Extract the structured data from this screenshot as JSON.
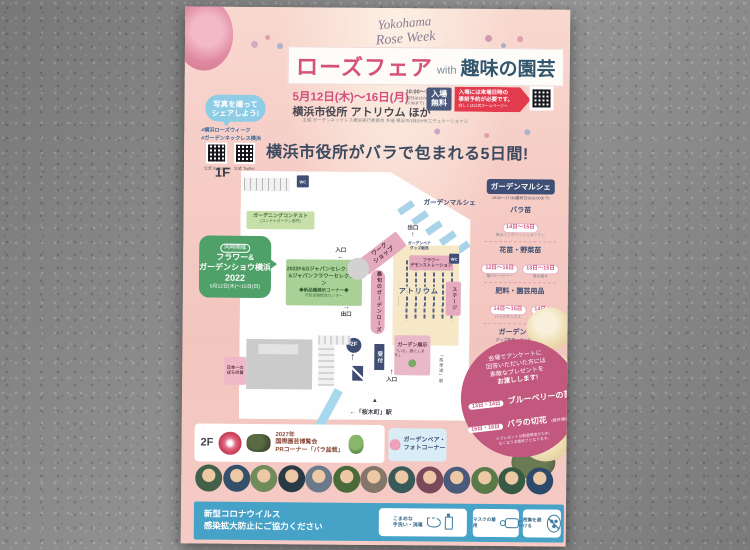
{
  "flyer": {
    "brand": {
      "line1": "Yokohama",
      "line2": "Rose Week"
    },
    "title": {
      "main": "ローズフェア",
      "with_word": "with",
      "sub": "趣味の園芸"
    },
    "info": {
      "date": "5月12日(木)〜16日(月)",
      "time1": "10:00〜18:00",
      "time2": "(初日は13:00〜、最終日は17:00まで)",
      "venue": "横浜市役所 アトリウム ほか",
      "admission1": "入場",
      "admission2": "無料",
      "reserve1": "入場には来場日時の",
      "reserve2": "事前予約が必要です。",
      "reserve3": "詳しくは公式ホームページへ",
      "credit": "主催 ガーデンネックレス横浜実行委員会 共催 横浜市/(株)NHKエデュケーショナル"
    },
    "share": {
      "bubble1": "写真を撮って",
      "bubble2": "シェアしよう!",
      "tag1": "#横浜ローズウィーク",
      "tag2": "#ガーデンネックレス横浜",
      "qr1": "公式 Instagram",
      "qr2": "公式 Twitter"
    },
    "headline": "横浜市役所がバラで包まれる5日間!",
    "map": {
      "floor": "1F",
      "wc": "WC",
      "marche_area": "ガーデンマルシェ",
      "contest1": "ガーデニングコンテスト",
      "contest2": "(コンテナガーデン部門)",
      "co_tag": "同時開催",
      "co_name1": "フラワー&",
      "co_name2": "ガーデンショウ横浜",
      "co_year": "2022",
      "co_date": "5月12日(木)〜15日(日)",
      "sel1": "2022F&Gジャパンセレクション",
      "sel2": "&ジャパンフラワーセレクション",
      "sel3": "◆新品種展示コーナー◆",
      "sel4": "市民協働推進センター",
      "entrance": "入口",
      "exit": "出口",
      "arrow_left": "←",
      "arrow_right": "→",
      "arrow_up": "↑",
      "tri": "▲",
      "workshop1": "ワーク",
      "workshop2": "ショップ",
      "bear1": "ガーデンベア",
      "bear2": "グッズ販売",
      "demo1": "フラワー",
      "demo2": "デモンストレーション",
      "rose_now": "最旬のガーデンローズ",
      "atrium": "アトリウム",
      "stage": "ステージ",
      "exhibit1": "ガーデン展示",
      "exhibit2": "「いえ、庭にします」",
      "reception": "受付",
      "no1a": "日本一の",
      "no1b": "ばらの苗",
      "to2f": "2F",
      "station_side": "「馬車道」駅",
      "station_bottom": "←「桜木町」駅"
    },
    "marche": {
      "title": "ガーデンマルシェ",
      "hours": "10:00〜17:00(最終日は16:00まで)",
      "sections": [
        {
          "name": "バラ苗",
          "slots": [
            {
              "days": "14日〜15日",
              "vendor": "横浜イングリッシュガーデン"
            }
          ]
        },
        {
          "name": "花苗・野菜苗",
          "slots": [
            {
              "days": "12日〜16日",
              "vendor": "亀川ナーセリー"
            },
            {
              "days": "13日〜15日",
              "vendor": "横浜植木"
            }
          ]
        },
        {
          "name": "肥料・園芸用品",
          "slots": [
            {
              "days": "14日〜15日",
              "vendor": "ハイポネックス"
            },
            {
              "days": "14日",
              "vendor": "東商"
            }
          ]
        },
        {
          "name": "ガーデンベア",
          "sub": "グッズ販売、キッチンカー",
          "slots": [
            {
              "days": "12日〜16日",
              "vendor": ""
            }
          ]
        }
      ],
      "note1": "※天候、混雑の場合や売り切れの",
      "note2": "場合は出展なしとなります。"
    },
    "prize": {
      "lead1": "会場でアンケートに",
      "lead2": "回答いただいた方には",
      "lead3": "素敵なプレゼントを",
      "lead4": "お渡しします!",
      "rows": [
        {
          "days": "13日・14日",
          "item": "ブルーベリーの苗",
          "note": ""
        },
        {
          "days": "15日・16日",
          "item": "バラの切花",
          "note": "(提供:横浜植木)"
        }
      ],
      "foot1": "※プレゼントは数量限定のため、",
      "foot2": "なくなり次第終了となります。"
    },
    "second_floor": {
      "floor": "2F",
      "expo1": "2027年",
      "expo2": "国際園芸博覧会",
      "expo3": "PRコーナー「バラ盆栽」",
      "photo1": "ガーデンベア・",
      "photo2": "フォトコーナー"
    },
    "footer": {
      "covid1": "新型コロナウイルス",
      "covid2": "感染拡大防止にご協力ください",
      "measures": [
        {
          "label1": "こまめな",
          "label2": "手洗い・消毒"
        },
        {
          "label1": "マスクの着用",
          "label2": ""
        },
        {
          "label1": "密集を避ける",
          "label2": ""
        }
      ]
    }
  }
}
